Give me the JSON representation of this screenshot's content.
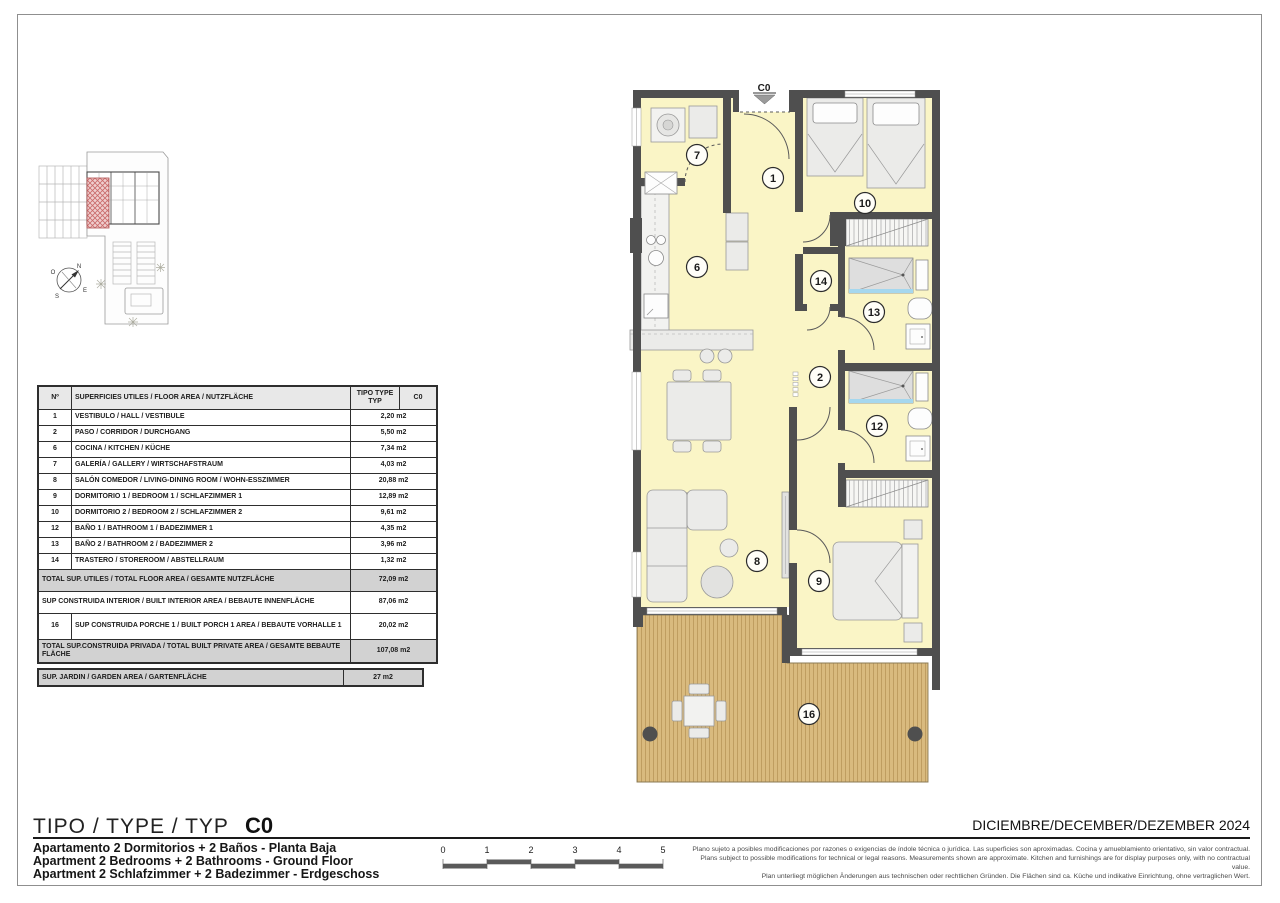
{
  "colors": {
    "wall": "#4f4f4f",
    "floor": "#faf5c6",
    "furniture": "#ebebe9",
    "line": "#999999",
    "deck": "#d9ba7e",
    "deck-line": "#bf9d60",
    "shower-blue": "#a5d7ee",
    "unit-red": "#cc6a6a",
    "table-gray": "#d2d2d2"
  },
  "title_block": {
    "type_label": "TIPO / TYPE / TYP",
    "type_code": "C0",
    "date_line": "DICIEMBRE/DECEMBER/DEZEMBER 2024",
    "subtitle_es": "Apartamento 2 Dormitorios + 2 Baños - Planta Baja",
    "subtitle_en": "Apartment 2 Bedrooms + 2 Bathrooms - Ground Floor",
    "subtitle_de": "Apartment 2 Schlafzimmer + 2 Badezimmer - Erdgeschoss",
    "disclaimer_es": "Plano sujeto a posibles modificaciones por razones o exigencias de índole técnica o jurídica. Las superficies son aproximadas. Cocina y amueblamiento orientativo, sin valor contractual.",
    "disclaimer_en": "Plans subject to possible modifications for technical or legal reasons. Measurements shown are approximate. Kitchen and furnishings are for display purposes only, with no contractual value.",
    "disclaimer_de": "Plan unterliegt möglichen Änderungen aus technischen oder rechtlichen Gründen. Die Flächen sind ca. Küche und indikative Einrichtung, ohne vertraglichen Wert."
  },
  "scale_bar": {
    "labels": [
      "0",
      "1",
      "2",
      "3",
      "4",
      "5"
    ]
  },
  "site_plan": {
    "compass": {
      "north": "N",
      "west": "O",
      "south": "S",
      "east": "E"
    }
  },
  "area_table": {
    "headers": {
      "num": "Nº",
      "desc": "SUPERFICIES UTILES / FLOOR AREA / NUTZFLÄCHE",
      "tipo": "TIPO TYPE TYP",
      "code": "C0"
    },
    "rows": [
      {
        "num": "1",
        "desc": "VESTIBULO / HALL / VESTIBULE",
        "value": "2,20 m2"
      },
      {
        "num": "2",
        "desc": "PASO / CORRIDOR / DURCHGANG",
        "value": "5,50 m2"
      },
      {
        "num": "6",
        "desc": "COCINA / KITCHEN / KÜCHE",
        "value": "7,34 m2"
      },
      {
        "num": "7",
        "desc": "GALERÍA / GALLERY / WIRTSCHAFSTRAUM",
        "value": "4,03 m2"
      },
      {
        "num": "8",
        "desc": "SALÓN COMEDOR / LIVING-DINING ROOM / WOHN-ESSZIMMER",
        "value": "20,88 m2"
      },
      {
        "num": "9",
        "desc": "DORMITORIO 1 / BEDROOM 1 / SCHLAFZIMMER 1",
        "value": "12,89 m2"
      },
      {
        "num": "10",
        "desc": "DORMITORIO 2 / BEDROOM 2 / SCHLAFZIMMER 2",
        "value": "9,61 m2"
      },
      {
        "num": "12",
        "desc": "BAÑO 1 / BATHROOM 1 / BADEZIMMER 1",
        "value": "4,35 m2"
      },
      {
        "num": "13",
        "desc": "BAÑO 2 / BATHROOM 2 / BADEZIMMER 2",
        "value": "3,96 m2"
      },
      {
        "num": "14",
        "desc": "TRASTERO / STOREROOM / ABSTELLRAUM",
        "value": "1,32 m2"
      }
    ],
    "total_utiles": {
      "desc": "TOTAL SUP. UTILES / TOTAL FLOOR AREA / GESAMTE NUTZFLÄCHE",
      "value": "72,09 m2"
    },
    "built_interior": {
      "desc": "SUP CONSTRUIDA INTERIOR / BUILT INTERIOR AREA / BEBAUTE INNENFLÄCHE",
      "value": "87,06 m2"
    },
    "porch_row": {
      "num": "16",
      "desc": "SUP CONSTRUIDA PORCHE 1 / BUILT PORCH 1 AREA / BEBAUTE VORHALLE 1",
      "value": "20,02 m2"
    },
    "total_privada": {
      "desc": "TOTAL SUP.CONSTRUIDA PRIVADA / TOTAL  BUILT PRIVATE AREA / GESAMTE BEBAUTE FLÄCHE",
      "value": "107,08 m2"
    },
    "garden_row": {
      "desc": "SUP. JARDIN / GARDEN AREA / GARTENFLÄCHE",
      "value": "27 m2"
    }
  },
  "floor_plan": {
    "entrance_label": "C0",
    "room_labels": [
      "7",
      "1",
      "10",
      "6",
      "14",
      "13",
      "2",
      "12",
      "8",
      "9",
      "16"
    ]
  }
}
